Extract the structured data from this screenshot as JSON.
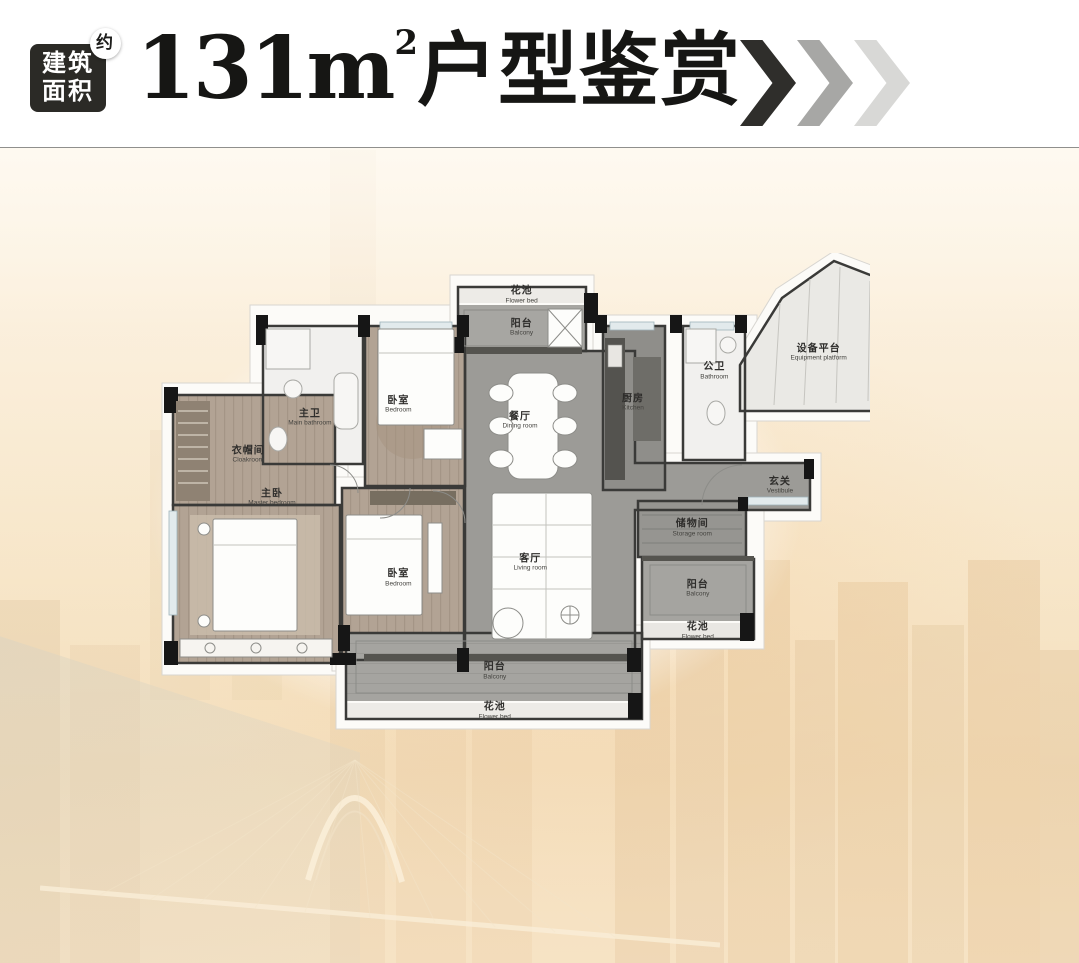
{
  "header": {
    "badge_line1": "建筑",
    "badge_line2": "面积",
    "badge_approx": "约",
    "title_number": "131",
    "title_unit": "m",
    "title_sup": "2",
    "title_text": "户型鉴赏"
  },
  "colors": {
    "badge_bg": "#2b2a26",
    "title_text": "#161614",
    "chevron_dark": "#2f2e2b",
    "chevron_mid": "#a7a7a5",
    "chevron_light": "#d8d8d6",
    "background_warm": "#f6e2c3",
    "plan_wall": "#3a3a38",
    "plan_wood_floor": "#b2a394",
    "plan_tile_floor": "#9c9b97"
  },
  "floorplan": {
    "rooms": [
      {
        "zh": "花池",
        "en": "Flower bed"
      },
      {
        "zh": "阳台",
        "en": "Balcony"
      },
      {
        "zh": "设备平台",
        "en": "Equipment platform"
      },
      {
        "zh": "公卫",
        "en": "Bathroom"
      },
      {
        "zh": "厨房",
        "en": "Kitchen"
      },
      {
        "zh": "餐厅",
        "en": "Dining room"
      },
      {
        "zh": "主卫",
        "en": "Main bathroom"
      },
      {
        "zh": "卧室",
        "en": "Bedroom"
      },
      {
        "zh": "衣帽间",
        "en": "Cloakroom"
      },
      {
        "zh": "主卧",
        "en": "Master bedroom"
      },
      {
        "zh": "卧室",
        "en": "Bedroom"
      },
      {
        "zh": "客厅",
        "en": "Living room"
      },
      {
        "zh": "玄关",
        "en": "Vestibule"
      },
      {
        "zh": "储物间",
        "en": "Storage room"
      },
      {
        "zh": "阳台",
        "en": "Balcony"
      },
      {
        "zh": "花池",
        "en": "Flower bed"
      },
      {
        "zh": "阳台",
        "en": "Balcony"
      },
      {
        "zh": "花池",
        "en": "Flower bed"
      }
    ]
  }
}
